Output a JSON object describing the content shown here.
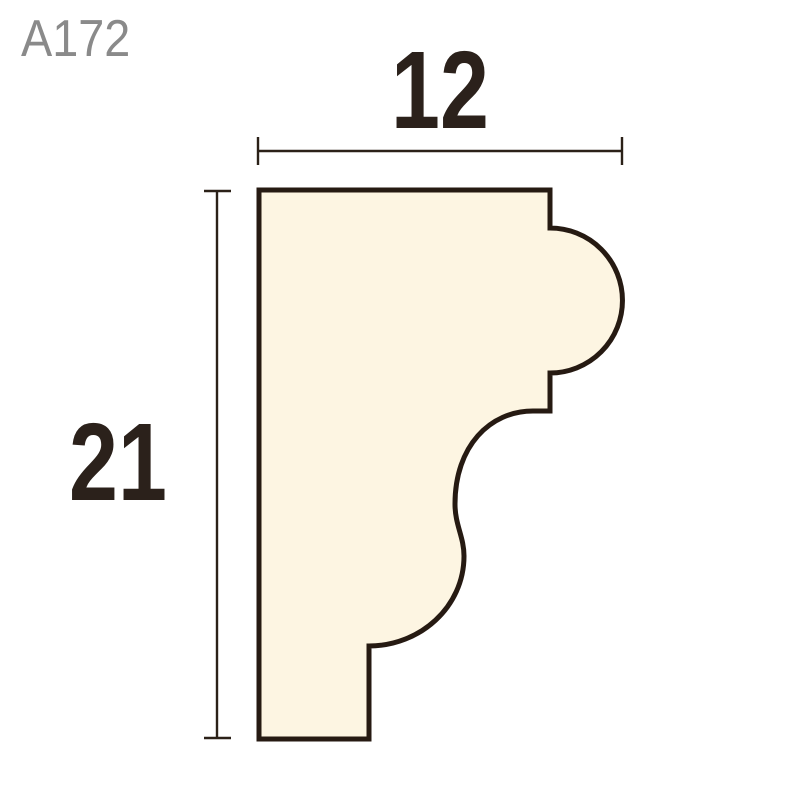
{
  "page": {
    "background_color": "#ffffff"
  },
  "header": {
    "product_code": "A172",
    "product_code_color": "#8a8a8a"
  },
  "dimensions": {
    "width": {
      "value": "12"
    },
    "height": {
      "value": "21"
    },
    "line_color": "#2b2118",
    "text_color": "#2b211b"
  },
  "profile": {
    "description": "moulding-cross-section",
    "fill": "#fdf5e2",
    "stroke": "#261a12",
    "stroke_width": "5",
    "path": "M 259 190 H 550 V 228 A 72.5 72.5 0 0 1 550 373 V 411 H 533 C 490 411 455 446 455 504 C 455 525 464 537 464 556 C 464 607 420 646 369 646 V 739 H 259 Z"
  }
}
